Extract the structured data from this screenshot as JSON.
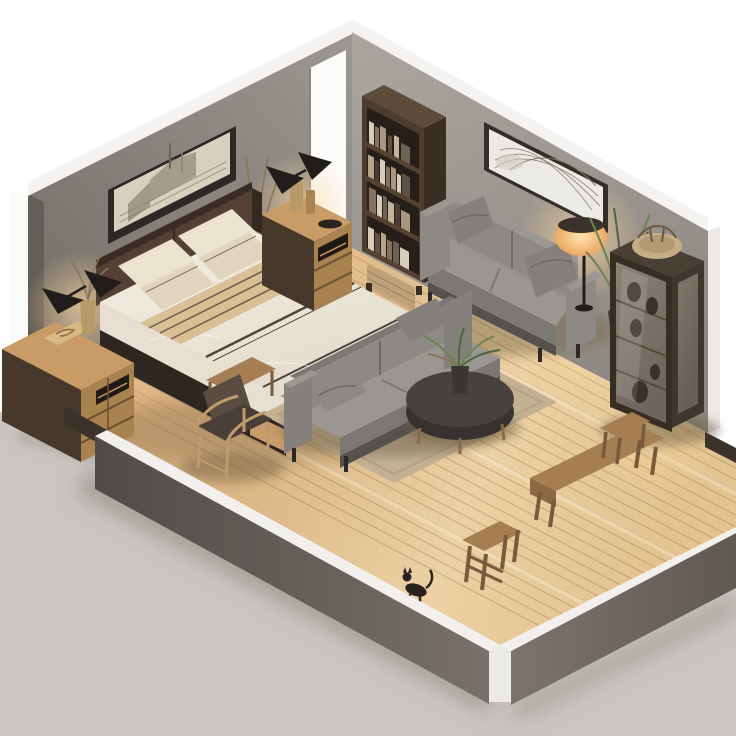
{
  "scene": {
    "description": "Isometric cutaway 3D render of a combined bedroom and living room with light wood floor, gray walls and low front parapet walls",
    "objects": [
      {
        "id": "bed",
        "label": "Double bed with dark leather headboard, cream pillows, tan striped blanket and white duvet"
      },
      {
        "id": "wall-art-left",
        "label": "Panoramic sepia architecture etching in dark frame"
      },
      {
        "id": "wall-art-right",
        "label": "Large abstract branch artwork in dark frame"
      },
      {
        "id": "dresser",
        "label": "Oak nightstand dresser with open shelf"
      },
      {
        "id": "nightstand-right",
        "label": "Oak nightstand with wooden bottles"
      },
      {
        "id": "wall-sconce-left",
        "label": "Black double-shade wall lamp, lit"
      },
      {
        "id": "wall-sconce-right",
        "label": "Black double-shade wall lamp, lit"
      },
      {
        "id": "bookshelf",
        "label": "Dark walnut open bookcase with books and wicker basket"
      },
      {
        "id": "sofa-right",
        "label": "Gray three-seat sofa against right wall"
      },
      {
        "id": "floor-lamp",
        "label": "Warm glowing floor lamp"
      },
      {
        "id": "plant",
        "label": "Tall green potted plant"
      },
      {
        "id": "display-cabinet",
        "label": "Tall glass display cabinet with rattan bowl on top"
      },
      {
        "id": "sofa-center",
        "label": "Gray sofa facing the coffee table"
      },
      {
        "id": "coffee-table",
        "label": "Round dark coffee table with small plant"
      },
      {
        "id": "rug",
        "label": "Beige woven area rug"
      },
      {
        "id": "armchair",
        "label": "Wood frame armchair with brown cushions"
      },
      {
        "id": "side-table",
        "label": "Small wooden side table"
      },
      {
        "id": "bench",
        "label": "Wooden bench"
      },
      {
        "id": "stool-small",
        "label": "Small wooden stool"
      },
      {
        "id": "stool-ladder",
        "label": "Square wooden step stool"
      },
      {
        "id": "cat-figurine",
        "label": "Small dark cat figurine on floor"
      },
      {
        "id": "doorway",
        "label": "White door opening in back-left wall"
      }
    ]
  },
  "colors": {
    "backdrop": "#ffffff",
    "ground": "#c9c5c0",
    "ground_shadow": "#9d978f",
    "floor_dark": "#c89a6e",
    "floor_mid": "#dab584",
    "floor_light": "#ecd1a4",
    "floor_right": "#e3c491",
    "wall_left_light": "#9c9791",
    "wall_left_dark": "#6f6a63",
    "wall_right_light": "#aba6a0",
    "wall_right_dark": "#8d8881",
    "wall_band": "#f4f3f1",
    "door_white": "#fbfbfa",
    "door_jamb": "#5f5a55",
    "plinth": "#3b332b",
    "parapet_top": "#f2f0ee",
    "parapet_left_a": "#4f4b46",
    "parapet_left_b": "#78716a",
    "parapet_right_a": "#7c756d",
    "parapet_right_b": "#5f5952",
    "corner_cap": "#eceae7",
    "art1_frame": "#2c2824",
    "art1_paper": "#d8d0bf",
    "art1_ink": "#8c7f6d",
    "art1_ink_dark": "#6e6354",
    "art2_frame": "#332e29",
    "art2_paper": "#eceae4",
    "art2_ink": "#9d958a",
    "bookshelf_front": "#4b3c30",
    "bookshelf_side": "#3a2e24",
    "bookshelf_top": "#5d4b3c",
    "bookshelf_interior": "#261f19",
    "shelf_board": "#55432f",
    "basket": "#bfa27a",
    "basket_line": "#9a7e58",
    "sofa_gray": "#8d8a85",
    "sofa_gray_light": "#9a9792",
    "sofa_gray_dark": "#7b7873",
    "sofa_base": "#55524e",
    "sofa_pillow": "#84817c",
    "leg_dark": "#2b2825",
    "lamp_black": "#211d1a",
    "glow_warm": "#ffd9a2",
    "lamp_shade_a": "#ffe2b0",
    "lamp_shade_b": "#eda861",
    "plant_green": "#6a8452",
    "plant_green_dark": "#4d6540",
    "pot_dark": "#3a3632",
    "cabinet_frame": "#362d25",
    "cabinet_side": "#3f362d",
    "cabinet_top": "#4a3f34",
    "glass_a": "#8a8176",
    "glass_b": "#6e665c",
    "rattan": "#c6ad85",
    "rattan_dark": "#b39a73",
    "bed_headboard": "#544035",
    "bed_headboard_dark": "#3a2c24",
    "bed_post": "#32291f",
    "pillow_cream": "#ece3cf",
    "pillow_shade": "#e0d5bc",
    "pillow_piping": "#8a7d63",
    "blanket": "#d9bf94",
    "blanket_stripe": "#6b5d4d",
    "duvet": "#f4efe6",
    "duvet_shade": "#e3dccd",
    "duvet_stripe": "#4e463c",
    "bed_drape": "#e6dfd2",
    "bed_base_dark": "#2e2721",
    "bed_rail": "#c79d6b",
    "wood_top": "#c89c64",
    "wood_front": "#a9834f",
    "wood_side": "#46382a",
    "wood_slot": "#1f1a15",
    "wood_seam": "#6b4f31",
    "tray": "#d9b983",
    "vase_wood": "#b99968",
    "dried_plant": "#8d7454",
    "rug": "#c3b192",
    "rug_border": "#b5a383",
    "table_top": "#474240",
    "table_side": "#37322f",
    "table_leg": "#8a6a48",
    "chair_cushion": "#594c41",
    "chair_seat": "#4a3f36",
    "chair_frame": "#c09a6c",
    "bench_wood": "#a67e53",
    "bench_side": "#8c6844",
    "bench_leg": "#7a5a3c",
    "cat": "#2a231d"
  }
}
